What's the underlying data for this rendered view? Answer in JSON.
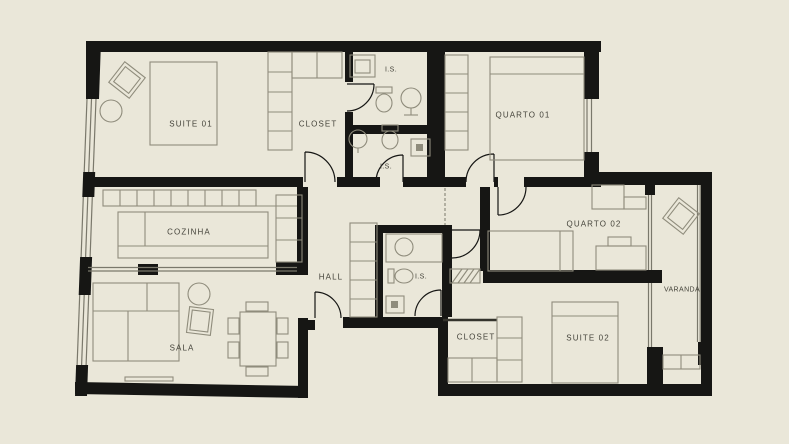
{
  "plan": {
    "labels": {
      "suite01": "SUITE 01",
      "closet1": "CLOSET",
      "is1": "I.S.",
      "quarto01": "QUARTO 01",
      "is2": "I.S.",
      "cozinha": "COZINHA",
      "hall": "HALL",
      "is3": "I.S.",
      "quarto02": "QUARTO 02",
      "varanda": "VARANDA",
      "sala": "SALA",
      "closet2": "CLOSET",
      "suite02": "SUITE 02"
    },
    "colors": {
      "bg": "#eae7d9",
      "wall": "#161614",
      "furniture": "#8f8c7c",
      "glass": "#7a786b",
      "thinwall": "#34332c",
      "text": "#44433a"
    }
  }
}
